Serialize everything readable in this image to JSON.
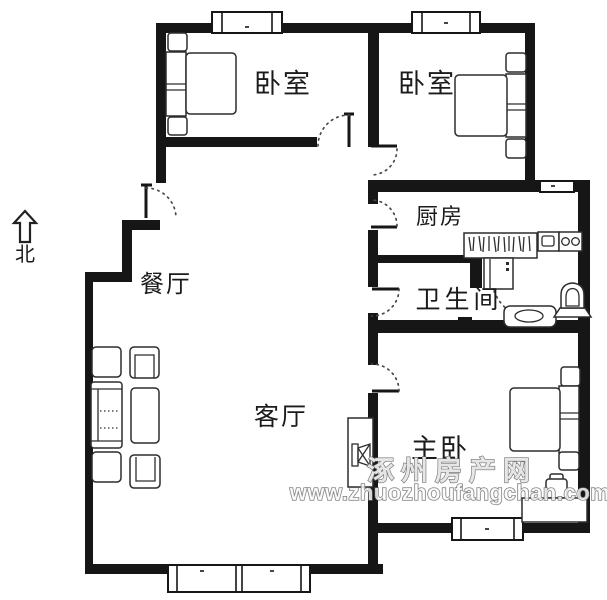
{
  "title": "apartment-floor-plan",
  "colors": {
    "background": "#ffffff",
    "wall": "#161616",
    "furniture_line": "#2d2d2d",
    "door_arc": "#4a4a4a",
    "label_text": "#1b1b1b",
    "watermark_fill": "#ffffff",
    "watermark_stroke": "#6e6e6e"
  },
  "compass": {
    "label": "北"
  },
  "rooms": {
    "bedroom_left": {
      "label": "卧室"
    },
    "bedroom_right": {
      "label": "卧室"
    },
    "kitchen": {
      "label": "厨房"
    },
    "bathroom": {
      "label": "卫生间"
    },
    "dining": {
      "label": "餐厅"
    },
    "living": {
      "label": "客厅"
    },
    "master": {
      "label": "主卧"
    }
  },
  "watermark": {
    "site_name": "涿州房产网",
    "site_url": "www.zhuozhoufangchan.com"
  }
}
